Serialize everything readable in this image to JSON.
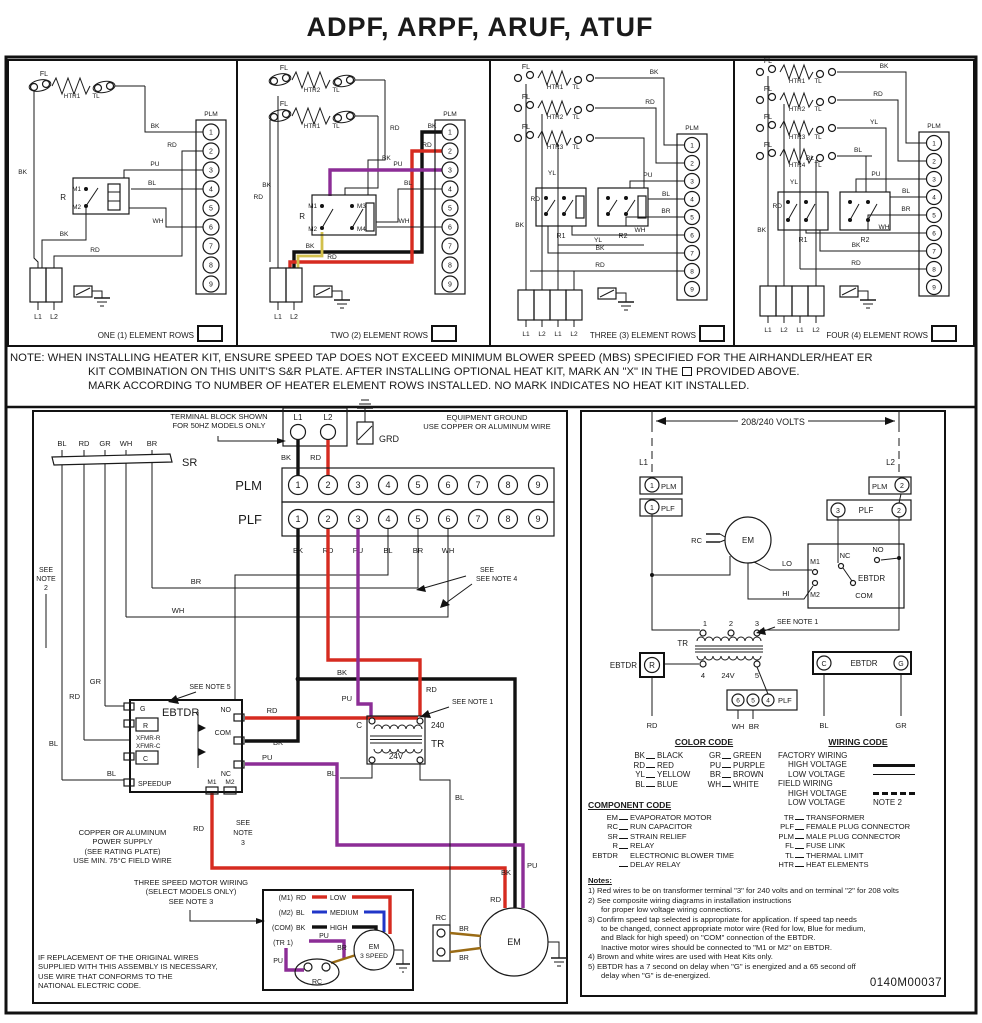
{
  "title": "ADPF, ARPF, ARUF, ATUF",
  "doc_number": "0140M00037",
  "wire": {
    "bk": "BK",
    "rd": "RD",
    "pu": "PU",
    "bl": "BL",
    "wh": "WH",
    "yl": "YL",
    "br": "BR",
    "gr": "GR"
  },
  "labels": {
    "fl": "FL",
    "tl": "TL",
    "htr1": "HTR1",
    "htr2": "HTR2",
    "htr3": "HTR3",
    "htr4": "HTR4",
    "r": "R",
    "r1": "R1",
    "r2": "R2",
    "m1": "M1",
    "m2": "M2",
    "m3": "M3",
    "m4": "M4",
    "l1": "L1",
    "l2": "L2",
    "plm": "PLM",
    "plf": "PLF",
    "grd": "GRD",
    "sr": "SR",
    "tr": "TR",
    "em": "EM",
    "rc": "RC",
    "ebtdr": "EBTDR",
    "no": "NO",
    "nc": "NC",
    "com": "COM",
    "g": "G",
    "c": "C",
    "lo": "LO",
    "hi": "HI",
    "v24": "24V",
    "v240": "240",
    "speedup": "SPEEDUP",
    "xfmr_r": "XFMR-R",
    "xfmr_c": "XFMR-C",
    "n1": "1",
    "n2": "2",
    "n3": "3",
    "n4": "4",
    "n5": "5"
  },
  "plug_numbers": [
    "1",
    "2",
    "3",
    "4",
    "5",
    "6",
    "7",
    "8",
    "9"
  ],
  "plf_low_numbers": [
    "6",
    "5",
    "4"
  ],
  "panels": {
    "one": "ONE (1) ELEMENT ROWS",
    "two": "TWO (2) ELEMENT ROWS",
    "three": "THREE (3) ELEMENT ROWS",
    "four": "FOUR (4) ELEMENT ROWS"
  },
  "note_box": {
    "line1": "NOTE: WHEN INSTALLING HEATER KIT, ENSURE SPEED TAP DOES NOT EXCEED MINIMUM BLOWER SPEED (MBS) SPECIFIED FOR THE AIRHANDLER/HEAT ER",
    "line2a": "KIT COMBINATION ON THIS UNIT'S S&R PLATE. AFTER INSTALLING OPTIONAL HEAT KIT, MARK AN \"X\" IN THE",
    "line2b": "PROVIDED ABOVE.",
    "line3": "MARK ACCORDING TO NUMBER OF HEATER ELEMENT ROWS INSTALLED. NO MARK INDICATES NO HEAT KIT INSTALLED."
  },
  "main": {
    "terminal_note1": "TERMINAL BLOCK SHOWN",
    "terminal_note2": "FOR 50HZ MODELS ONLY",
    "equip_ground1": "EQUIPMENT GROUND",
    "equip_ground2": "USE COPPER OR ALUMINUM WIRE",
    "see": "SEE",
    "note2": "NOTE",
    "note2n": "2",
    "see_note1": "SEE NOTE 1",
    "see_note4": "SEE NOTE 4",
    "see_note5": "SEE NOTE 5",
    "note3a": "SEE",
    "note3b": "NOTE",
    "note3c": "3",
    "volts": "208/240 VOLTS",
    "power1": "COPPER OR ALUMINUM",
    "power2": "POWER SUPPLY",
    "power3": "(SEE RATING PLATE)",
    "power4": "USE MIN. 75°C FIELD WIRE",
    "threespeed1": "THREE SPEED MOTOR WIRING",
    "threespeed2": "(SELECT MODELS ONLY)",
    "threespeed3": "SEE NOTE 3",
    "m1p": "(M1)",
    "m2p": "(M2)",
    "comp": "(COM)",
    "tr1p": "(TR 1)",
    "low": "LOW",
    "medium": "MEDIUM",
    "high": "HIGH",
    "em3a": "EM",
    "em3b": "3 SPEED",
    "replace1": "IF REPLACEMENT OF THE ORIGINAL WIRES",
    "replace2": "SUPPLIED WITH THIS ASSEMBLY  IS NECESSARY,",
    "replace3": "USE WIRE THAT  CONFORMS TO THE",
    "replace4": "NATIONAL ELECTRIC CODE."
  },
  "legend": {
    "color_code": {
      "title": "COLOR CODE",
      "entries": [
        [
          "BK",
          "BLACK"
        ],
        [
          "GR",
          "GREEN"
        ],
        [
          "RD",
          "RED"
        ],
        [
          "PU",
          "PURPLE"
        ],
        [
          "YL",
          "YELLOW"
        ],
        [
          "BR",
          "BROWN"
        ],
        [
          "BL",
          "BLUE"
        ],
        [
          "WH",
          "WHITE"
        ]
      ]
    },
    "wiring_code": {
      "title": "WIRING CODE",
      "factory": "FACTORY WIRING",
      "field": "FIELD WIRING",
      "high": "HIGH VOLTAGE",
      "low": "LOW VOLTAGE",
      "note2": "NOTE 2"
    },
    "component_code": {
      "title": "COMPONENT CODE",
      "left": [
        [
          "EM",
          "EVAPORATOR MOTOR"
        ],
        [
          "RC",
          "RUN CAPACITOR"
        ],
        [
          "SR",
          "STRAIN RELIEF"
        ],
        [
          "R",
          "RELAY"
        ],
        [
          "EBTDR",
          "ELECTRONIC BLOWER TIME\nDELAY RELAY"
        ]
      ],
      "right": [
        [
          "TR",
          "TRANSFORMER"
        ],
        [
          "PLF",
          "FEMALE PLUG CONNECTOR"
        ],
        [
          "PLM",
          "MALE PLUG CONNECTOR"
        ],
        [
          "FL",
          "FUSE LINK"
        ],
        [
          "TL",
          "THERMAL LIMIT"
        ],
        [
          "HTR",
          "HEAT ELEMENTS"
        ]
      ]
    }
  },
  "notes": {
    "title": "Notes:",
    "items": [
      "1) Red wires to be on transformer terminal \"3\" for 240 volts and on terminal \"2\" for 208 volts",
      "2) See composite wiring diagrams in installation instructions\nfor proper low voltage wiring connections.",
      "3) Confirm speed tap selected is appropriate for application. If speed tap needs\nto be changed, connect appropriate motor wire (Red for low, Blue for medium,\nand Black for high speed) on \"COM\" connection of the EBTDR.\nInactive motor wires should be connected to \"M1 or M2\" on EBTDR.",
      "4) Brown and white wires are used with Heat Kits only.",
      "5) EBTDR has a 7 second on delay when \"G\" is energized and a 65 second off\ndelay when \"G\" is de-energized."
    ]
  }
}
